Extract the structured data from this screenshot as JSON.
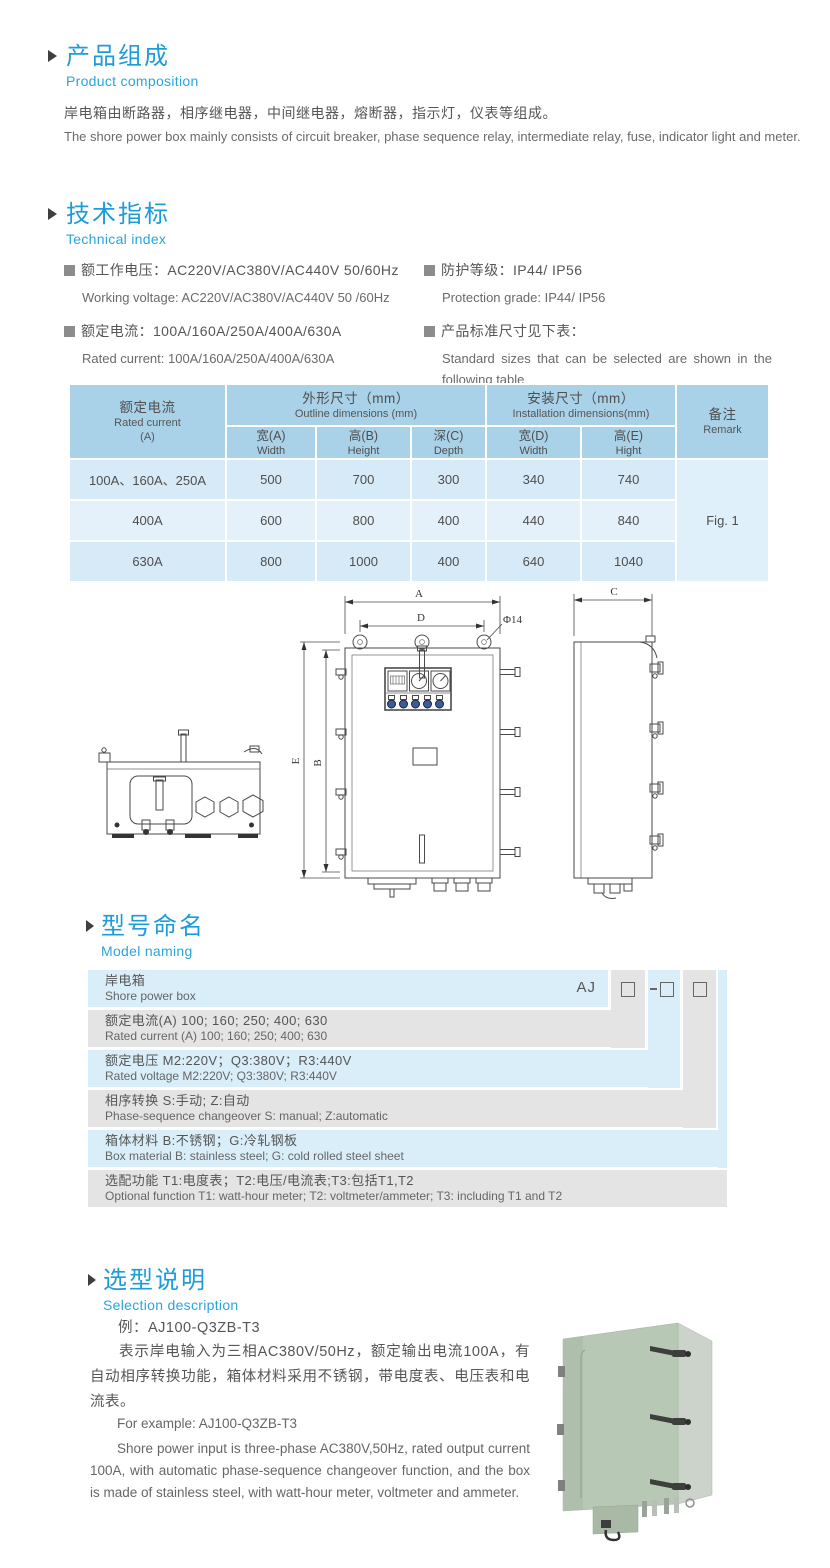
{
  "colors": {
    "accent_blue": "#1e9cd8",
    "subtitle_blue": "#2ba4dc",
    "table_header_bg": "#a9d2e9",
    "table_row_light": "#d7eaf7",
    "table_row_lighter": "#e4f1fa",
    "naming_blue": "#d9eef9",
    "naming_gray": "#e4e4e4",
    "photo_green": "#b7c9b4"
  },
  "product_composition": {
    "title_zh": "产品组成",
    "title_en": "Product  composition",
    "body_zh": "岸电箱由断路器，相序继电器，中间继电器，熔断器，指示灯，仪表等组成。",
    "body_en": "The shore power box mainly consists of circuit breaker, phase sequence relay, intermediate relay, fuse, indicator light and meter."
  },
  "technical_index": {
    "title_zh": "技术指标",
    "title_en": "Technical index",
    "specs_left": [
      {
        "zh": "额工作电压：AC220V/AC380V/AC440V 50/60Hz",
        "en": "Working voltage: AC220V/AC380V/AC440V 50 /60Hz"
      },
      {
        "zh": "额定电流：100A/160A/250A/400A/630A",
        "en": "Rated current: 100A/160A/250A/400A/630A"
      }
    ],
    "specs_right": [
      {
        "zh": "防护等级：IP44/ IP56",
        "en": "Protection grade: IP44/ IP56"
      },
      {
        "zh": "产品标准尺寸见下表：",
        "en": "Standard sizes that can be selected are shown in the following table"
      }
    ]
  },
  "dim_table": {
    "header": {
      "rated_current_zh": "额定电流",
      "rated_current_en": "Rated current",
      "rated_current_unit": "(A)",
      "outline_zh": "外形尺寸（mm）",
      "outline_en": "Outline dimensions (mm)",
      "install_zh": "安装尺寸（mm）",
      "install_en": "Installation dimensions(mm)",
      "remark_zh": "备注",
      "remark_en": "Remark",
      "cols": [
        {
          "zh": "宽(A)",
          "en": "Width"
        },
        {
          "zh": "高(B)",
          "en": "Height"
        },
        {
          "zh": "深(C)",
          "en": "Depth"
        },
        {
          "zh": "宽(D)",
          "en": "Width"
        },
        {
          "zh": "高(E)",
          "en": "Hight"
        }
      ]
    },
    "rows": [
      {
        "current": "100A、160A、250A",
        "width_a": "500",
        "height_b": "700",
        "depth_c": "300",
        "width_d": "340",
        "height_e": "740"
      },
      {
        "current": "400A",
        "width_a": "600",
        "height_b": "800",
        "depth_c": "400",
        "width_d": "440",
        "height_e": "840"
      },
      {
        "current": "630A",
        "width_a": "800",
        "height_b": "1000",
        "depth_c": "400",
        "width_d": "640",
        "height_e": "1040"
      }
    ],
    "remark_value": "Fig. 1"
  },
  "drawing": {
    "labels": {
      "a": "A",
      "d": "D",
      "phi": "Φ14",
      "e": "E",
      "b": "B",
      "c": "C"
    }
  },
  "model_naming": {
    "title_zh": "型号命名",
    "title_en": "Model naming",
    "prefix": "AJ",
    "rows": [
      {
        "zh": "岸电箱",
        "en": "Shore power box"
      },
      {
        "zh": "额定电流(A)  100; 160; 250; 400; 630",
        "en": "Rated current (A) 100; 160; 250; 400; 630"
      },
      {
        "zh": "额定电压   M2:220V；Q3:380V；R3:440V",
        "en": "Rated voltage  M2:220V;  Q3:380V;  R3:440V"
      },
      {
        "zh": "相序转换  S:手动; Z:自动",
        "en": "Phase-sequence changeover  S: manual;  Z:automatic"
      },
      {
        "zh": "箱体材料    B:不锈钢；G:冷轧钢板",
        "en": "Box material   B: stainless steel; G: cold rolled steel sheet"
      },
      {
        "zh": "选配功能      T1:电度表；T2:电压/电流表;T3:包括T1,T2",
        "en": "Optional function  T1: watt-hour meter; T2: voltmeter/ammeter; T3: including T1 and T2"
      }
    ]
  },
  "selection": {
    "title_zh": "选型说明",
    "title_en": "Selection description",
    "example_zh": "例：AJ100-Q3ZB-T3",
    "desc_zh": "表示岸电输入为三相AC380V/50Hz，额定输出电流100A，有自动相序转换功能，箱体材料采用不锈钢，带电度表、电压表和电流表。",
    "example_en": "For example: AJ100-Q3ZB-T3",
    "desc_en": "Shore power input is three-phase AC380V,50Hz, rated output current 100A, with automatic phase-sequence changeover function, and the box is made of stainless steel, with watt-hour meter, voltmeter and ammeter."
  }
}
